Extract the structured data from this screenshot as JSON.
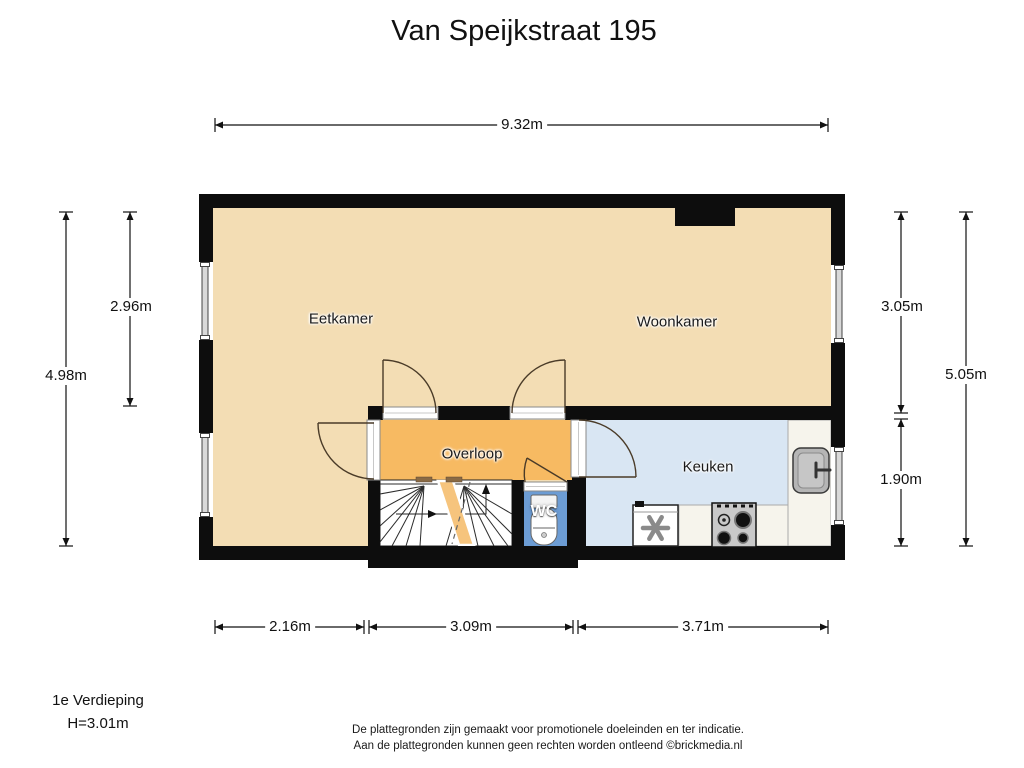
{
  "title": "Van Speijkstraat 195",
  "plan": {
    "rooms": {
      "eetkamer": "Eetkamer",
      "woonkamer": "Woonkamer",
      "overloop": "Overloop",
      "keuken": "Keuken",
      "wc": "WC"
    },
    "colors": {
      "wall": "#0d0d0d",
      "floor_living": "#f3ddb4",
      "floor_overloop": "#f7ba62",
      "floor_kitchen": "#d9e6f3",
      "floor_wc": "#6c9cd4",
      "counter": "#f6f4ec",
      "stair_accent": "#f6c47d"
    }
  },
  "dimensions": {
    "top_width": "9.32m",
    "left_outer_height": "4.98m",
    "left_inner_height": "2.96m",
    "right_inner_top": "3.05m",
    "right_inner_bottom": "1.90m",
    "right_outer_height": "5.05m",
    "bottom_left": "2.16m",
    "bottom_middle": "3.09m",
    "bottom_right": "3.71m"
  },
  "footer": {
    "floor_label": "1e Verdieping",
    "ceiling_height": "H=3.01m",
    "disclaimer_line1": "De plattegronden zijn gemaakt voor promotionele doeleinden en ter indicatie.",
    "disclaimer_line2": "Aan de plattegronden kunnen geen rechten worden ontleend ©brickmedia.nl"
  }
}
